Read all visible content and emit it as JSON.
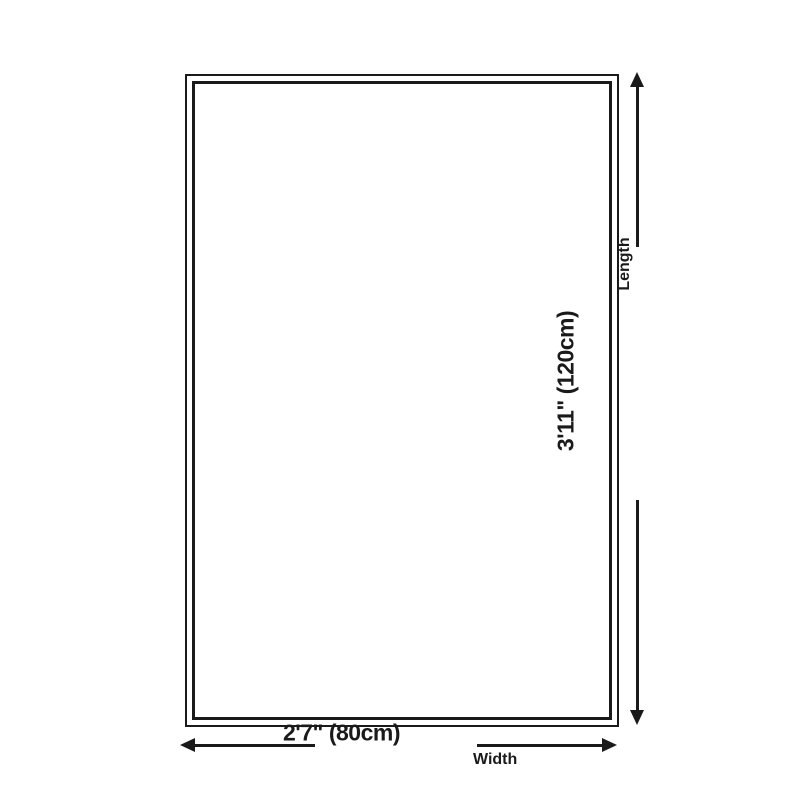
{
  "diagram": {
    "background_color": "#ffffff",
    "line_color": "#1a1a1a",
    "length": {
      "value": "3'11\" (120cm)",
      "label": "Length"
    },
    "width": {
      "value": "2'7\" (80cm)",
      "label": "Width"
    }
  }
}
